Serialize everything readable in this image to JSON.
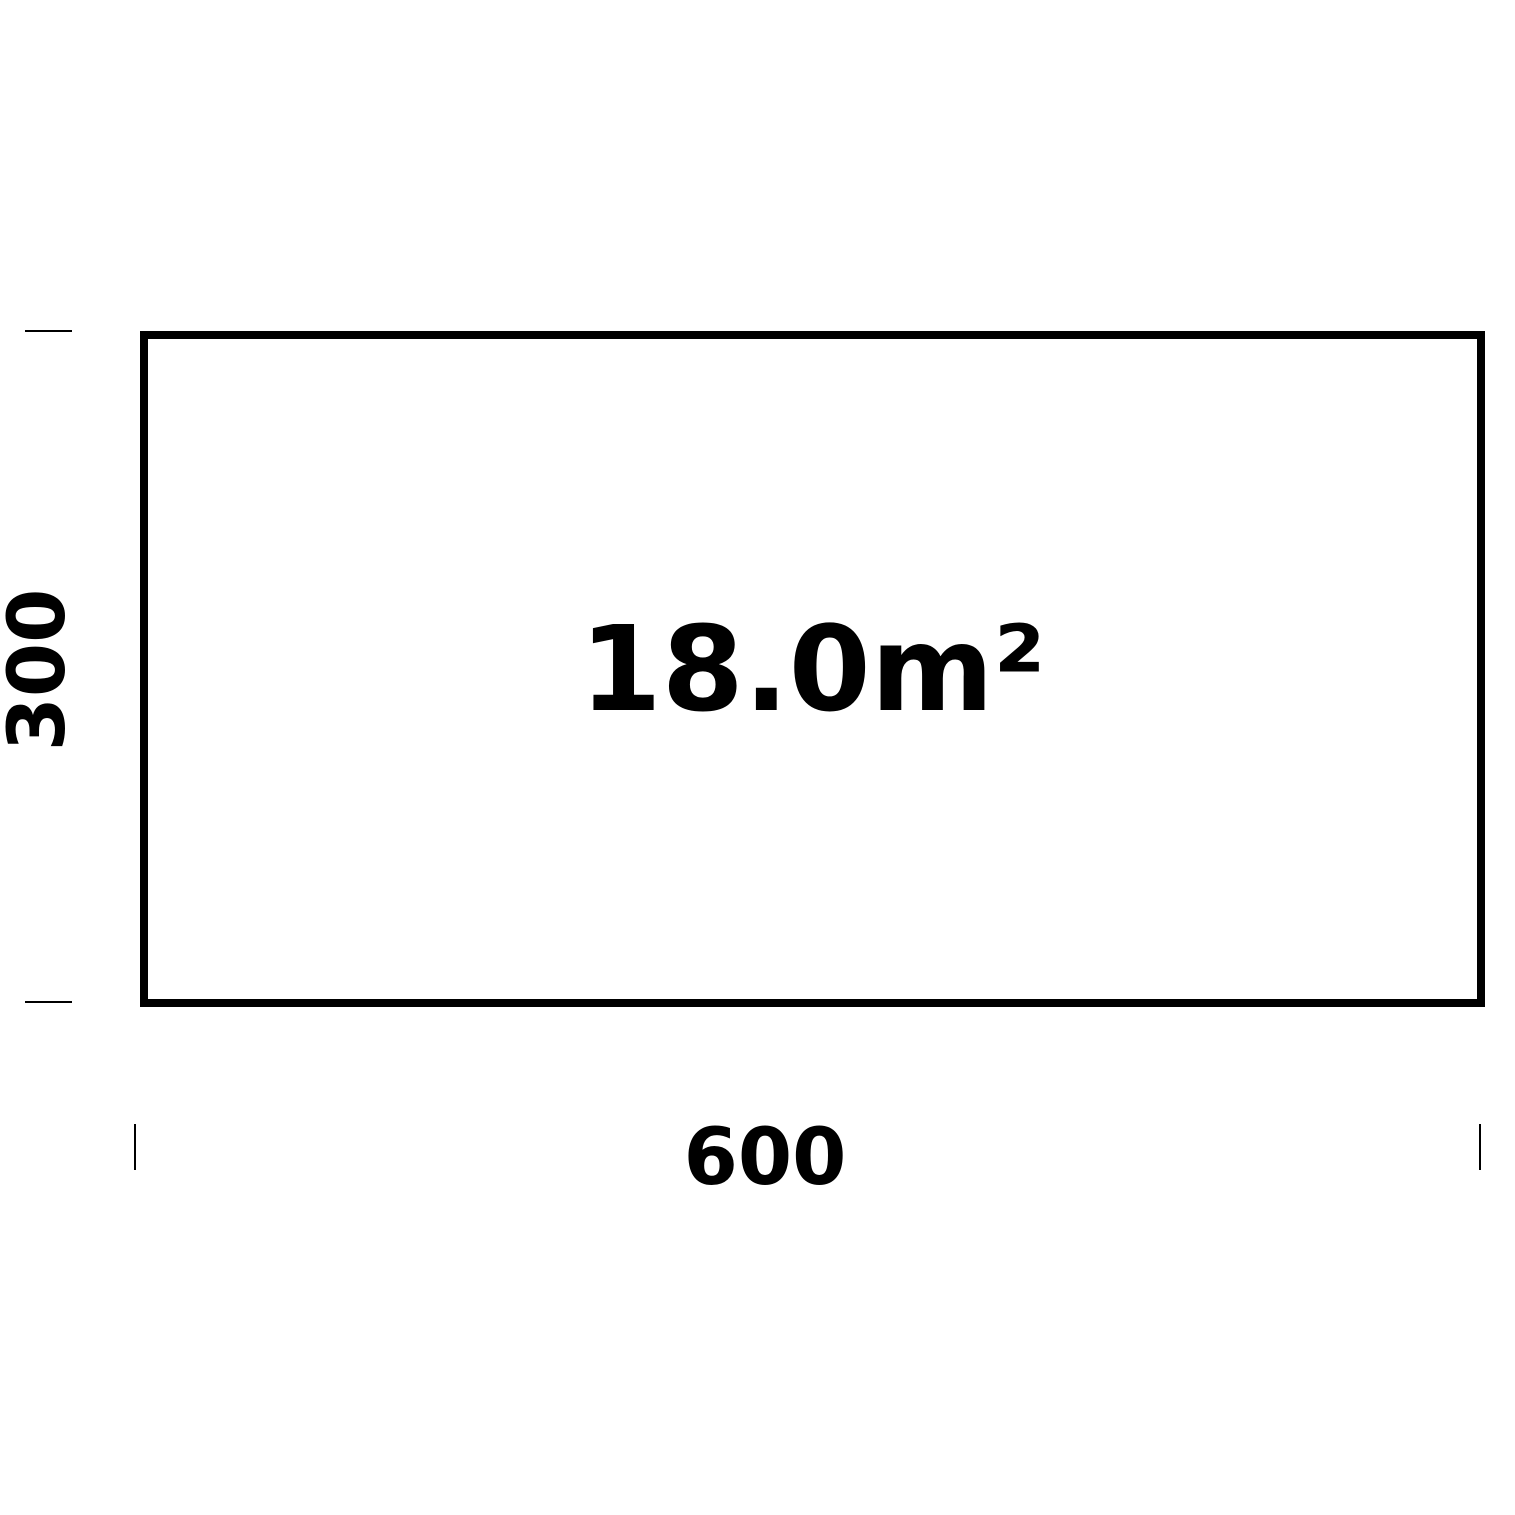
{
  "diagram": {
    "room": {
      "area_label": "18.0m²",
      "width_label": "600",
      "height_label": "300"
    },
    "colors": {
      "line": "#000000",
      "text": "#000000",
      "background": "#ffffff"
    }
  }
}
